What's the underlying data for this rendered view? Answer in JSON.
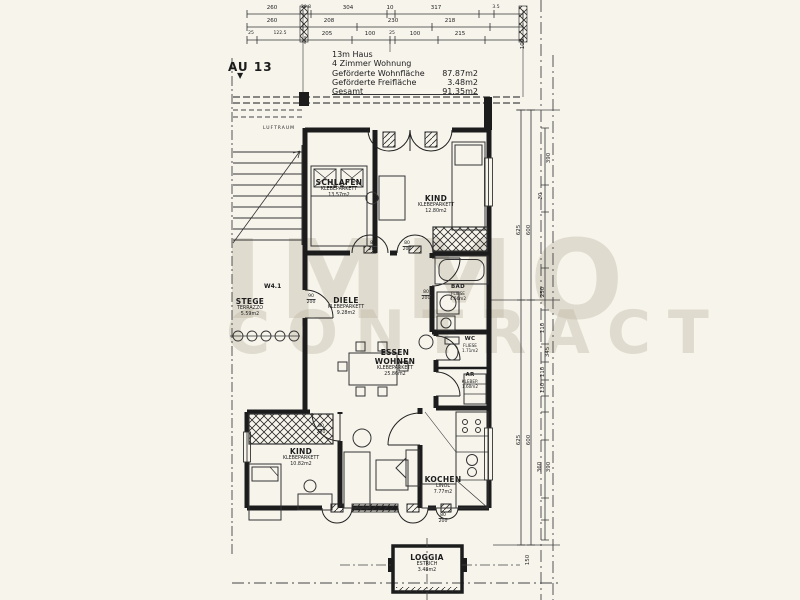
{
  "watermark": {
    "line1": "IMMO",
    "line2": "CONTRACT"
  },
  "marker": {
    "label": "AU 13",
    "arrow": "▼"
  },
  "header": {
    "title": "13m Haus",
    "subtitle": "4 Zimmer Wohnung",
    "rows": [
      {
        "label": "Geförderte Wohnfläche",
        "value": "87.87m2"
      },
      {
        "label": "Geförderte Freifläche",
        "value": "3.48m2"
      },
      {
        "label": "Gesamt",
        "value": "91.35m2"
      }
    ]
  },
  "dimensions": {
    "top_row1": [
      "260",
      "20.8",
      "304",
      "10",
      "317",
      "3.5"
    ],
    "top_row2": [
      "260",
      "208",
      "230",
      "218"
    ],
    "top_row3": [
      "25",
      "122.5",
      "205",
      "100",
      "25",
      "100",
      "215"
    ],
    "right_column": [
      "100",
      "390",
      "30",
      "625",
      "600",
      "250",
      "110",
      "345",
      "110",
      "130",
      "625",
      "600",
      "360",
      "390",
      "150"
    ]
  },
  "rooms": {
    "schlafen": {
      "name": "SCHLAFEN",
      "floor": "KLEBEPARKETT",
      "area": "13.57m2"
    },
    "kind1": {
      "name": "KIND",
      "floor": "KLEBEPARKETT",
      "area": "12.80m2"
    },
    "stege": {
      "name": "STEGE",
      "floor": "TERRAZZO",
      "area": "5.59m2"
    },
    "diele": {
      "name": "DIELE",
      "floor": "KLEBEPARKETT",
      "area": "9.28m2"
    },
    "bad": {
      "name": "BAD",
      "floor": "FLIESE",
      "area": "4.56m2"
    },
    "essen": {
      "name": "ESSEN",
      "name2": "WOHNEN",
      "floor": "KLEBEPARKETT",
      "area": "25.86m2"
    },
    "wc": {
      "name": "WC",
      "floor": "FLIESE",
      "area": "1.71m2"
    },
    "ar": {
      "name": "AR",
      "floor": "KLEBEP.",
      "area": "1.60m2"
    },
    "kind2": {
      "name": "KIND",
      "floor": "KLEBEPARKETT",
      "area": "10.82m2"
    },
    "kochen": {
      "name": "KOCHEN",
      "floor": "LINOL",
      "area": "7.77m2"
    },
    "loggia": {
      "name": "LOGGIA",
      "floor": "ESTRICH",
      "area": "3.48m2"
    }
  },
  "annotations": {
    "luftraum": "LUFTRAUM",
    "wall_tag": "W4.1"
  },
  "doors": [
    {
      "w": "90",
      "h": "200"
    },
    {
      "w": "80",
      "h": "200"
    },
    {
      "w": "80",
      "h": "200"
    },
    {
      "w": "80",
      "h": "200"
    },
    {
      "w": "80",
      "h": "200"
    },
    {
      "w": "80",
      "h": "200"
    }
  ],
  "colors": {
    "paper": "#f7f4ec",
    "ink": "#1c1c1c",
    "watermark": "#bab2a0"
  }
}
